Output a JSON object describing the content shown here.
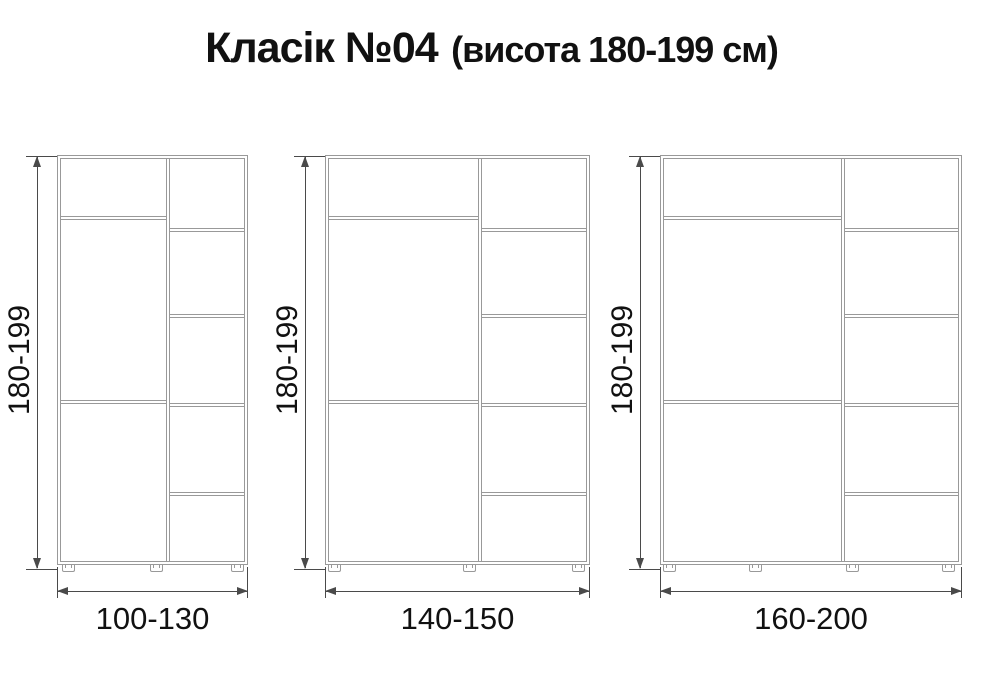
{
  "title": {
    "main": "Класік №04",
    "suffix": "(висота 180-199 см)"
  },
  "colors": {
    "cabinet_line": "#999999",
    "dimension_line": "#4a4a4a",
    "text_color": "#111111",
    "background": "#ffffff"
  },
  "wardrobes": [
    {
      "height_label": "180-199",
      "width_label": "100-130",
      "layout": {
        "left": 57,
        "width": 191,
        "divider_x": 111,
        "left_shelves_y": [
          61,
          245
        ],
        "right_shelves_y": [
          73,
          159,
          248,
          337
        ],
        "feet_fx": [
          0.055,
          0.52,
          0.945
        ]
      }
    },
    {
      "height_label": "180-199",
      "width_label": "140-150",
      "layout": {
        "left": 325,
        "width": 265,
        "divider_x": 155,
        "left_shelves_y": [
          61,
          245
        ],
        "right_shelves_y": [
          73,
          159,
          248,
          337
        ],
        "feet_fx": [
          0.035,
          0.545,
          0.955
        ]
      }
    },
    {
      "height_label": "180-199",
      "width_label": "160-200",
      "layout": {
        "left": 660,
        "width": 302,
        "divider_x": 183,
        "left_shelves_y": [
          61,
          245
        ],
        "right_shelves_y": [
          73,
          159,
          248,
          337
        ],
        "feet_fx": [
          0.03,
          0.315,
          0.635,
          0.955
        ]
      }
    }
  ]
}
